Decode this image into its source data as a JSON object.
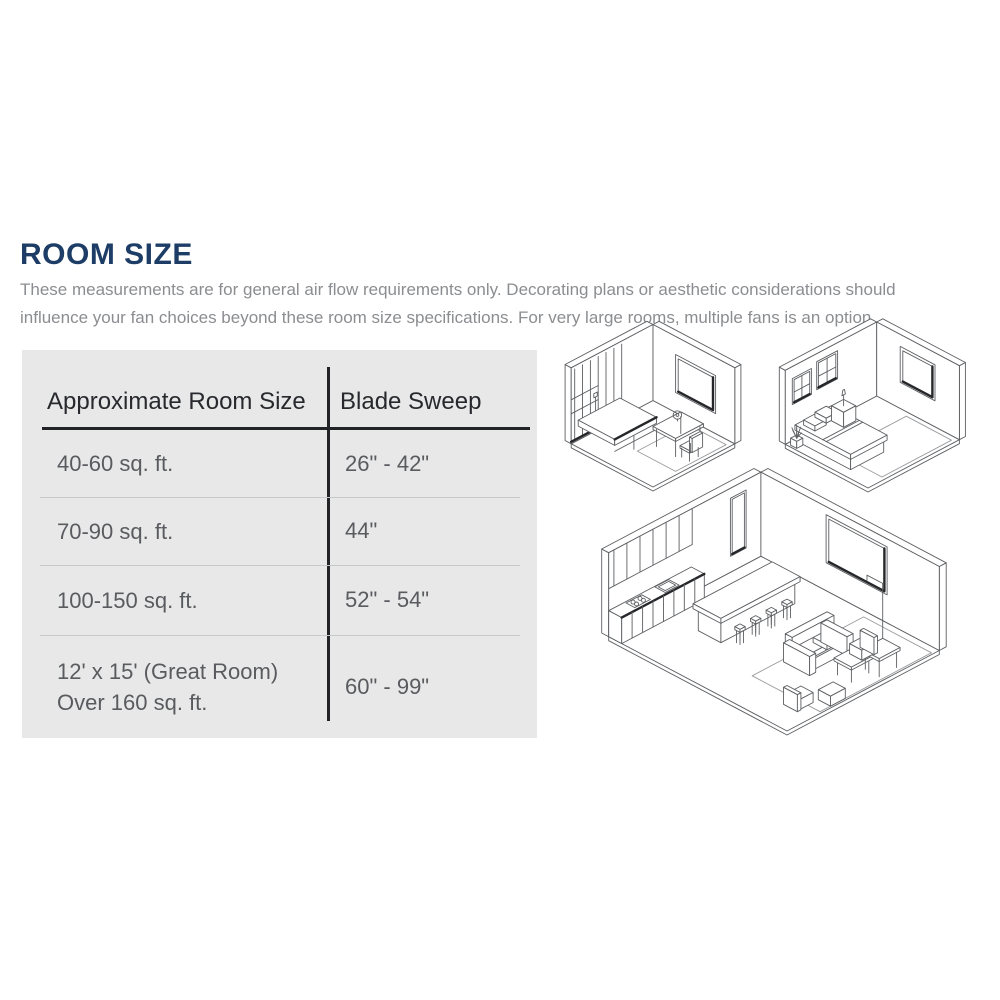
{
  "page": {
    "background": "#ffffff"
  },
  "section": {
    "title": "ROOM SIZE",
    "title_color": "#1d3d66",
    "description": "These measurements are for general air flow requirements only. Decorating plans or aesthetic considerations should influence your fan choices beyond these room size specifications. For very large rooms, multiple fans is an option."
  },
  "table": {
    "background": "#e8e8e9",
    "headers": [
      "Approximate Room Size",
      "Blade Sweep"
    ],
    "rows": [
      {
        "size": "40-60 sq. ft.",
        "size2": "",
        "sweep": "26\" - 42\""
      },
      {
        "size": "70-90 sq. ft.",
        "size2": "",
        "sweep": "44\""
      },
      {
        "size": "100-150 sq. ft.",
        "size2": "",
        "sweep": "52\" - 54\""
      },
      {
        "size": "12' x 15' (Great Room)",
        "size2": "Over 160 sq. ft.",
        "sweep": "60\" - 99\""
      }
    ]
  },
  "illustrations": [
    {
      "name": "small-room",
      "label": "Small room isometric line drawing (desk, chair, built-in counter, window)"
    },
    {
      "name": "bedroom",
      "label": "Bedroom isometric line drawing (bed, pillows, nightstand, windows, plant, rug)"
    },
    {
      "name": "great-room",
      "label": "Great room isometric line drawing (kitchen wall, island with stools, sofa, lamp, tables, window)"
    }
  ],
  "chart_data": {
    "type": "table",
    "columns": [
      "Approximate Room Size",
      "Blade Sweep"
    ],
    "rows": [
      [
        "40-60 sq. ft.",
        "26\" - 42\""
      ],
      [
        "70-90 sq. ft.",
        "44\""
      ],
      [
        "100-150 sq. ft.",
        "52\" - 54\""
      ],
      [
        "12' x 15' (Great Room) Over 160 sq. ft.",
        "60\" - 99\""
      ]
    ]
  }
}
